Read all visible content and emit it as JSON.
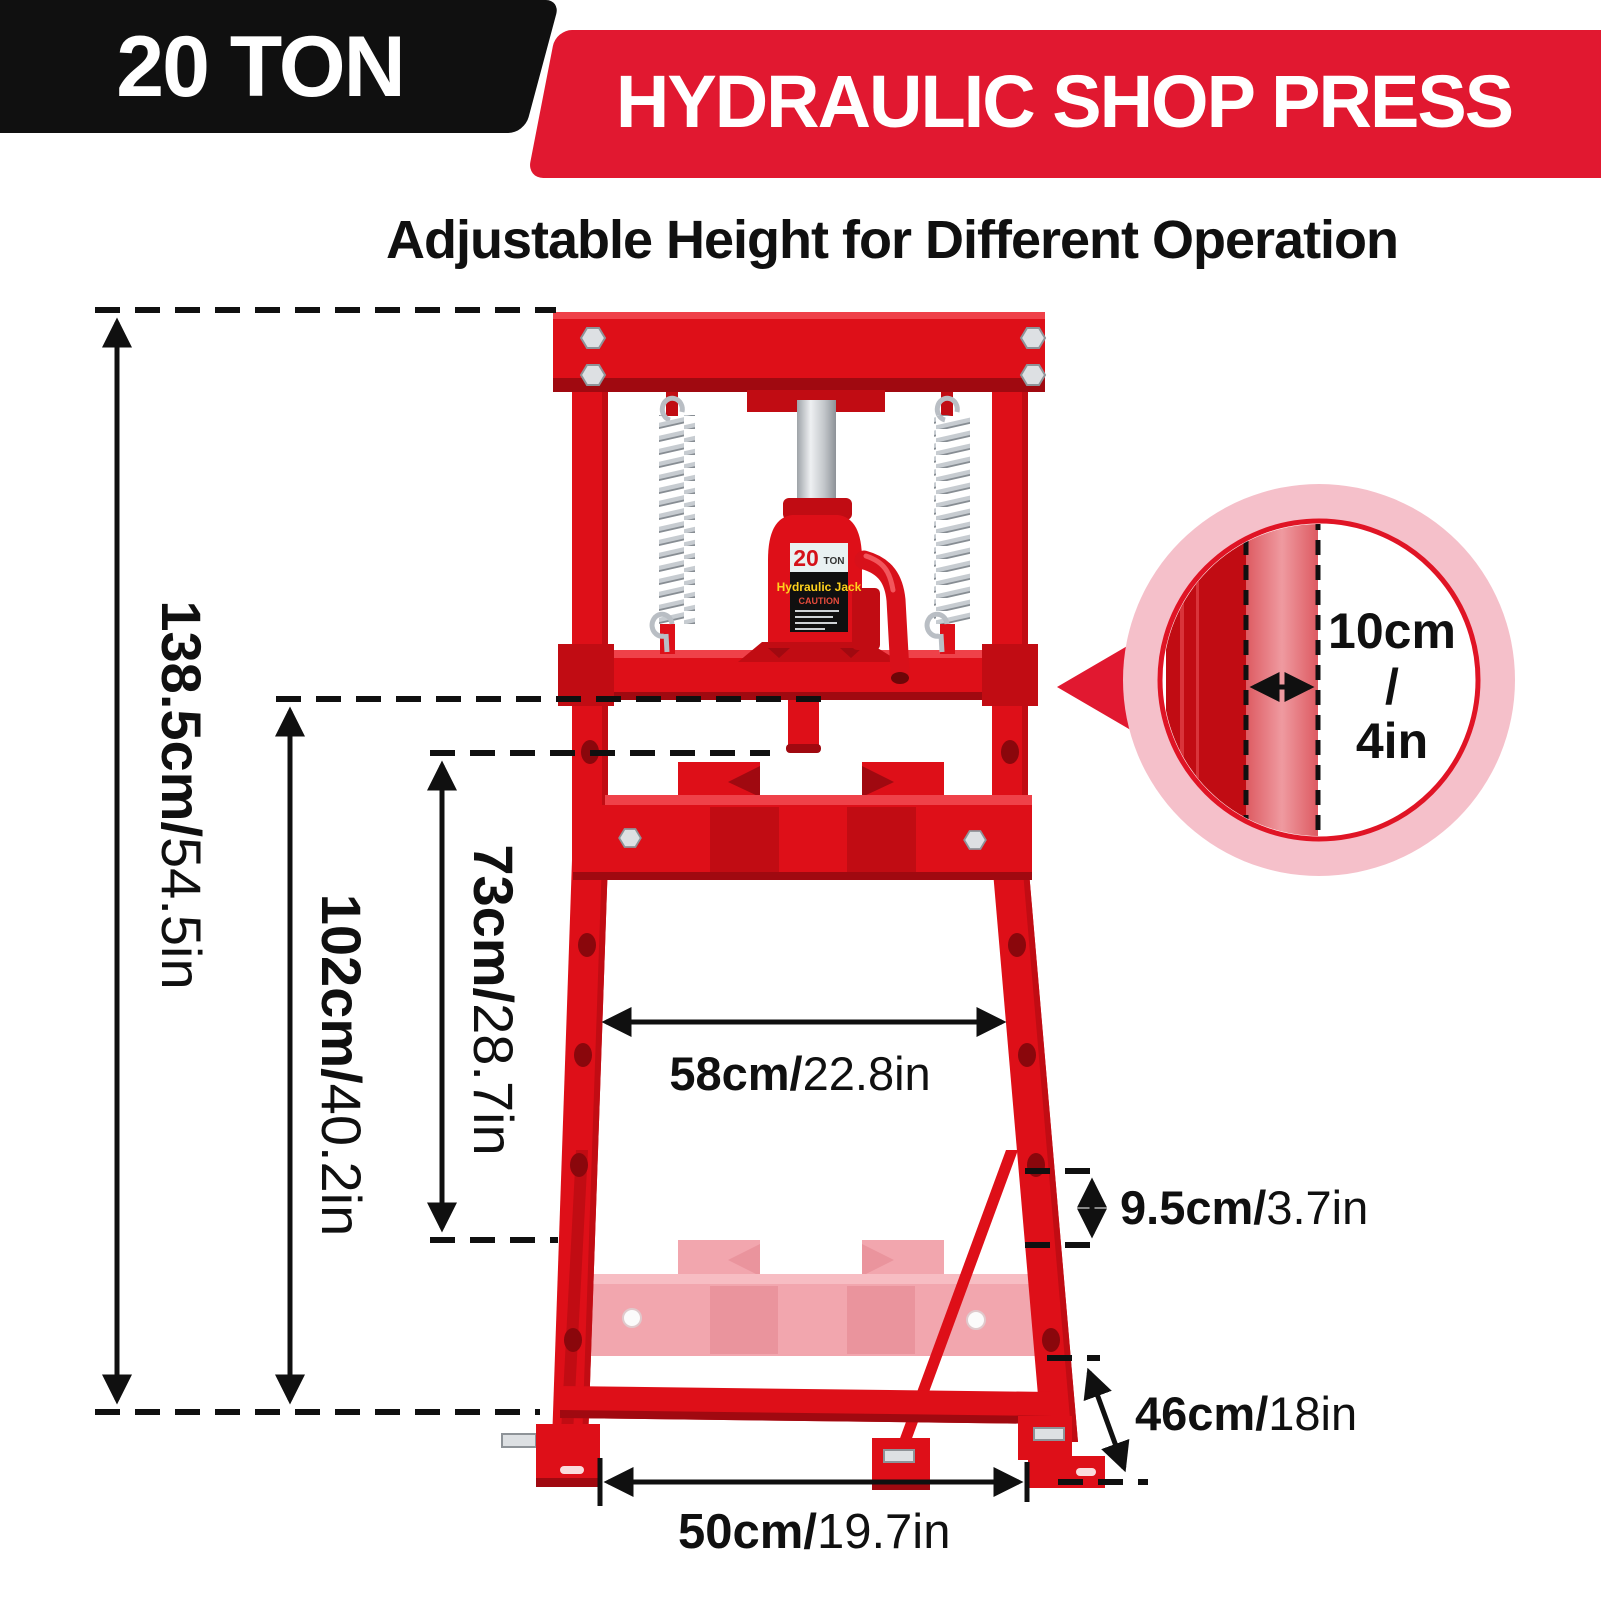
{
  "header": {
    "capacity_badge": "20 TON",
    "title": "HYDRAULIC SHOP PRESS",
    "subtitle": "Adjustable Height for Different Operation"
  },
  "dimensions": {
    "total_height": {
      "metric": "138.5cm/",
      "imperial": "54.5in"
    },
    "working_height": {
      "metric": "102cm/",
      "imperial": "40.2in"
    },
    "ram_to_table": {
      "metric": "73cm/",
      "imperial": "28.7in"
    },
    "working_width": {
      "metric": "58cm/",
      "imperial": "22.8in"
    },
    "hole_spacing": {
      "metric": "9.5cm/",
      "imperial": "3.7in"
    },
    "base_depth": {
      "metric": "46cm/",
      "imperial": "18in"
    },
    "base_width": {
      "metric": "50cm/",
      "imperial": "19.7in"
    },
    "post_width": {
      "metric": "10cm",
      "separator": "/",
      "imperial": "4in"
    }
  },
  "jack_label": {
    "capacity": "20",
    "unit": "TON",
    "title": "Hydraulic Jack",
    "caution": "CAUTION"
  },
  "colors": {
    "press_red": "#de0f18",
    "press_deep": "#c10c13",
    "press_dark": "#a00910",
    "press_light": "#ef4149",
    "banner_red": "#e11830",
    "ink": "#101010",
    "silver": "#dde0e3",
    "silver_dark": "#8e9398",
    "ghost_pink": "#f2a6ae",
    "ghost_light": "#f7bdc3",
    "ghost_deep": "#ea949d",
    "callout_pink": "#f5c0ca",
    "hole_red": "#8a070c",
    "label_yellow": "#ffd21c",
    "label_caution": "#e84b3c"
  }
}
